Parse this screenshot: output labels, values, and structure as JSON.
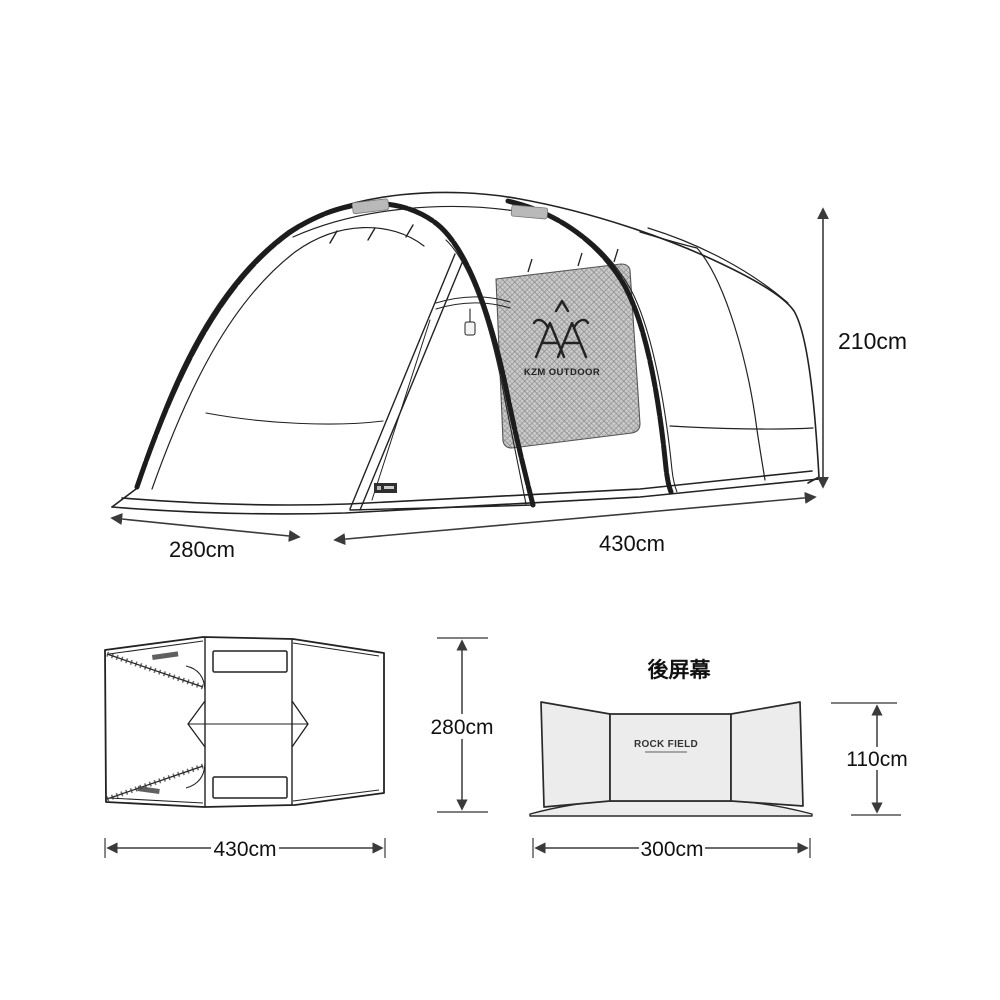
{
  "page": {
    "background": "#ffffff",
    "description_labels": []
  },
  "colors": {
    "line": "#222222",
    "pole": "#1c1c1c",
    "dimension_line": "#3a3a3a",
    "text": "#111111",
    "mesh_fill": "#cbcbcb",
    "mesh_grid": "#949494",
    "panel_fill": "#ececec",
    "roof_patch_fill": "#b9b9b9",
    "tag_fill": "#2f2f2f"
  },
  "main_view": {
    "name": "tent-perspective-view",
    "logo_icon": "kzm-antler-emblem-icon",
    "logo_text": "KZM OUTDOOR",
    "dims": {
      "height": "210cm",
      "width": "280cm",
      "length": "430cm"
    }
  },
  "plan_view": {
    "name": "tent-top-down-view",
    "dims": {
      "depth": "280cm",
      "length": "430cm"
    }
  },
  "screen_view": {
    "name": "rear-windscreen-view",
    "title": "後屏幕",
    "brand": "ROCK FIELD",
    "dims": {
      "height": "110cm",
      "width": "300cm"
    }
  }
}
